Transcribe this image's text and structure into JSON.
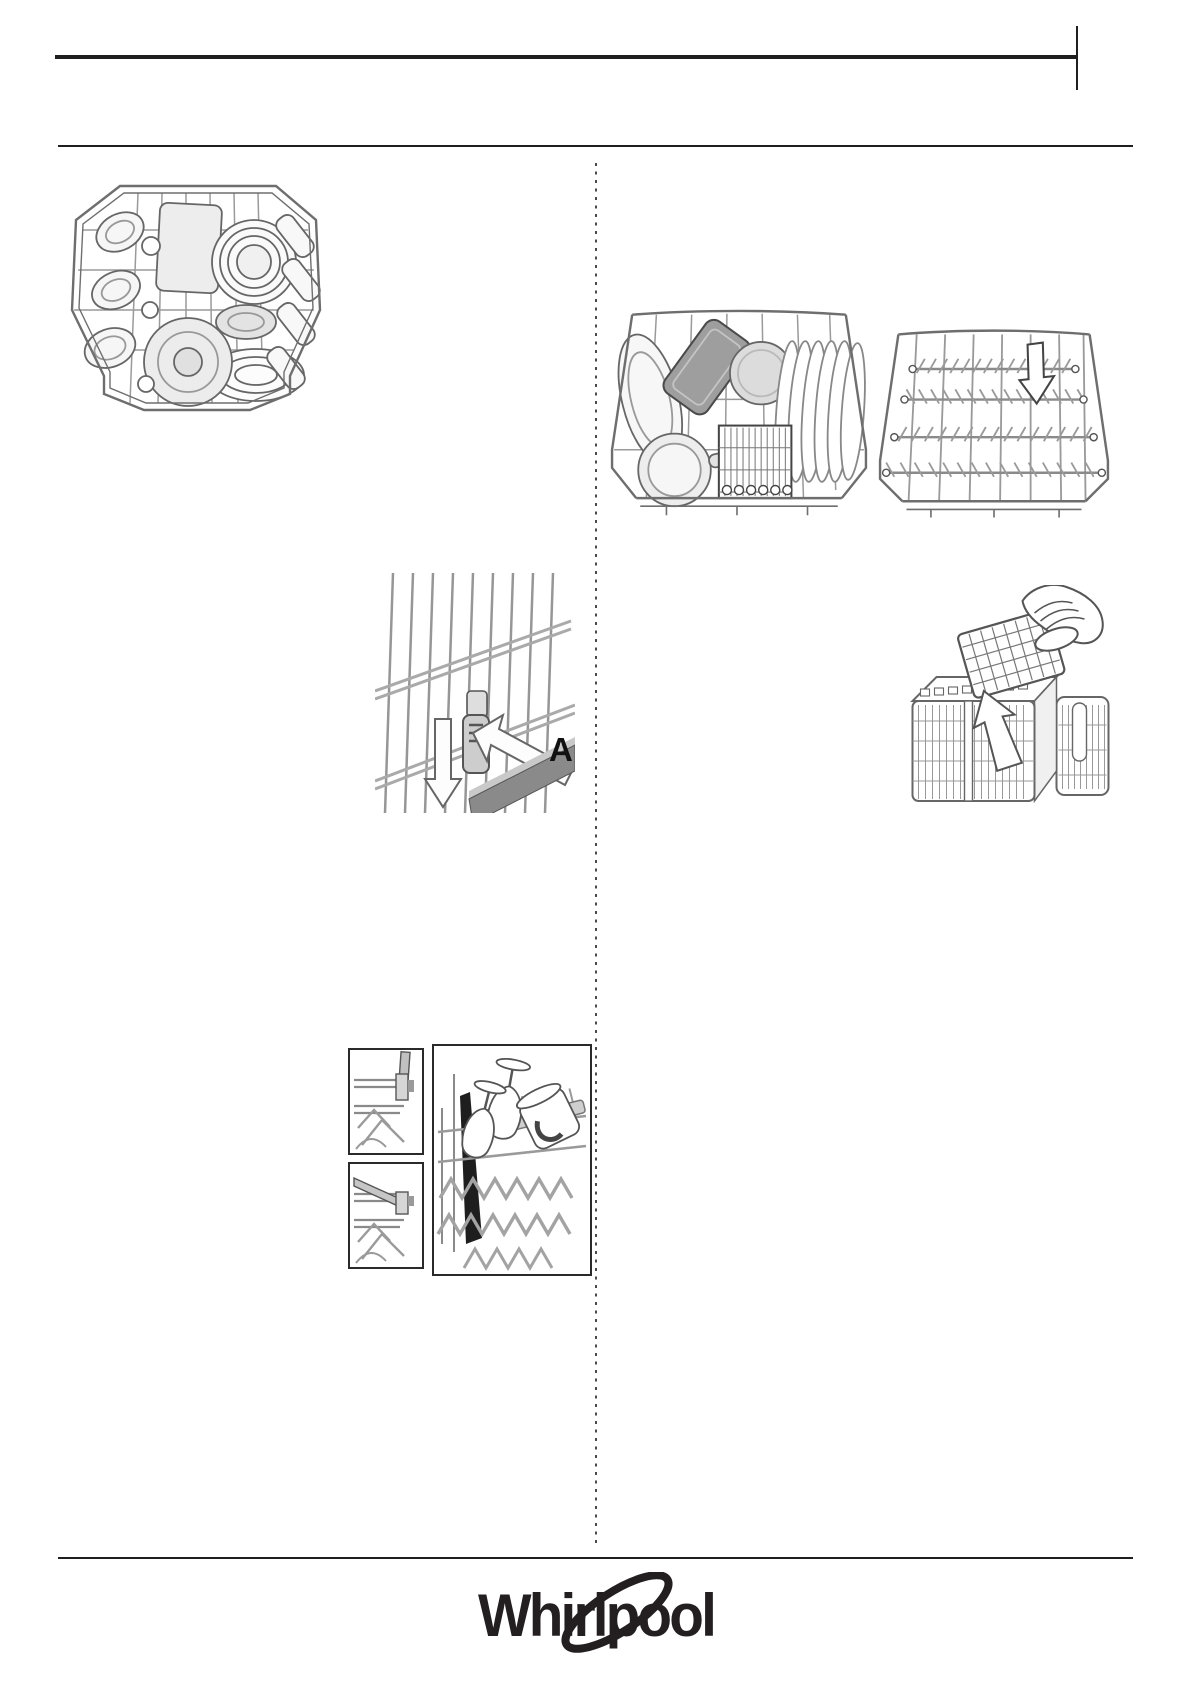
{
  "page": {
    "type": "appliance-manual-illustration-page",
    "background": "#ffffff"
  },
  "labels": {
    "position_a": "A"
  },
  "footer": {
    "brand": "Whirlpool"
  },
  "colors": {
    "rule": "#1f1f1f",
    "wire_gray": "#8a8a8a",
    "light_gray_fill": "#e6e6e6",
    "mid_gray_fill": "#c6c6c6",
    "dark_gray_fill": "#8f8f8f",
    "logo": "#231f20"
  },
  "illustrations": [
    {
      "name": "upper-rack-top-view"
    },
    {
      "name": "lower-rack-loaded"
    },
    {
      "name": "lower-rack-empty"
    },
    {
      "name": "upper-rack-height-adjustment",
      "label": "A"
    },
    {
      "name": "cutlery-basket-tray-removal"
    },
    {
      "name": "foldable-flap-up"
    },
    {
      "name": "foldable-flap-down"
    },
    {
      "name": "foldable-flap-with-glasses"
    }
  ]
}
